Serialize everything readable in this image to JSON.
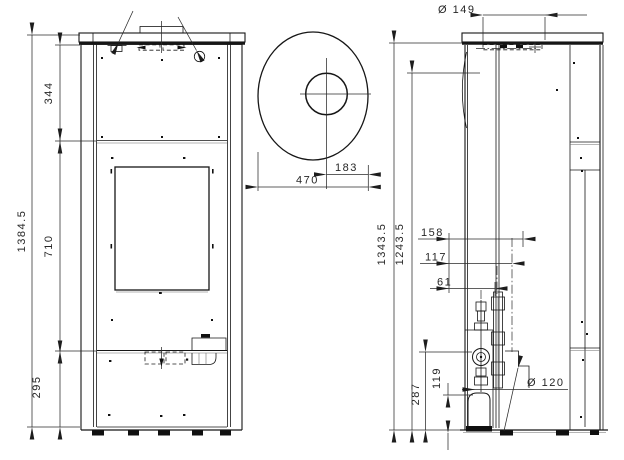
{
  "drawing": {
    "type": "technical-orthographic-views-of-stove",
    "front_view": {
      "dims": {
        "overall_height": "1384.5",
        "upper_section": "344",
        "middle_section": "710",
        "lower_section": "295"
      }
    },
    "top_view": {
      "dims": {
        "flue_center_offset": "183",
        "body_width": "470"
      }
    },
    "side_view": {
      "dims": {
        "flue_collar_diameter": "Ø 149",
        "total_height": "1343.5",
        "secondary_height": "1243.5",
        "connection_offset_1": "158",
        "connection_offset_2": "117",
        "connection_offset_3": "61",
        "rear_outlet_diameter": "Ø 120",
        "outlet_center_height": "287",
        "drain_height": "119"
      }
    }
  }
}
